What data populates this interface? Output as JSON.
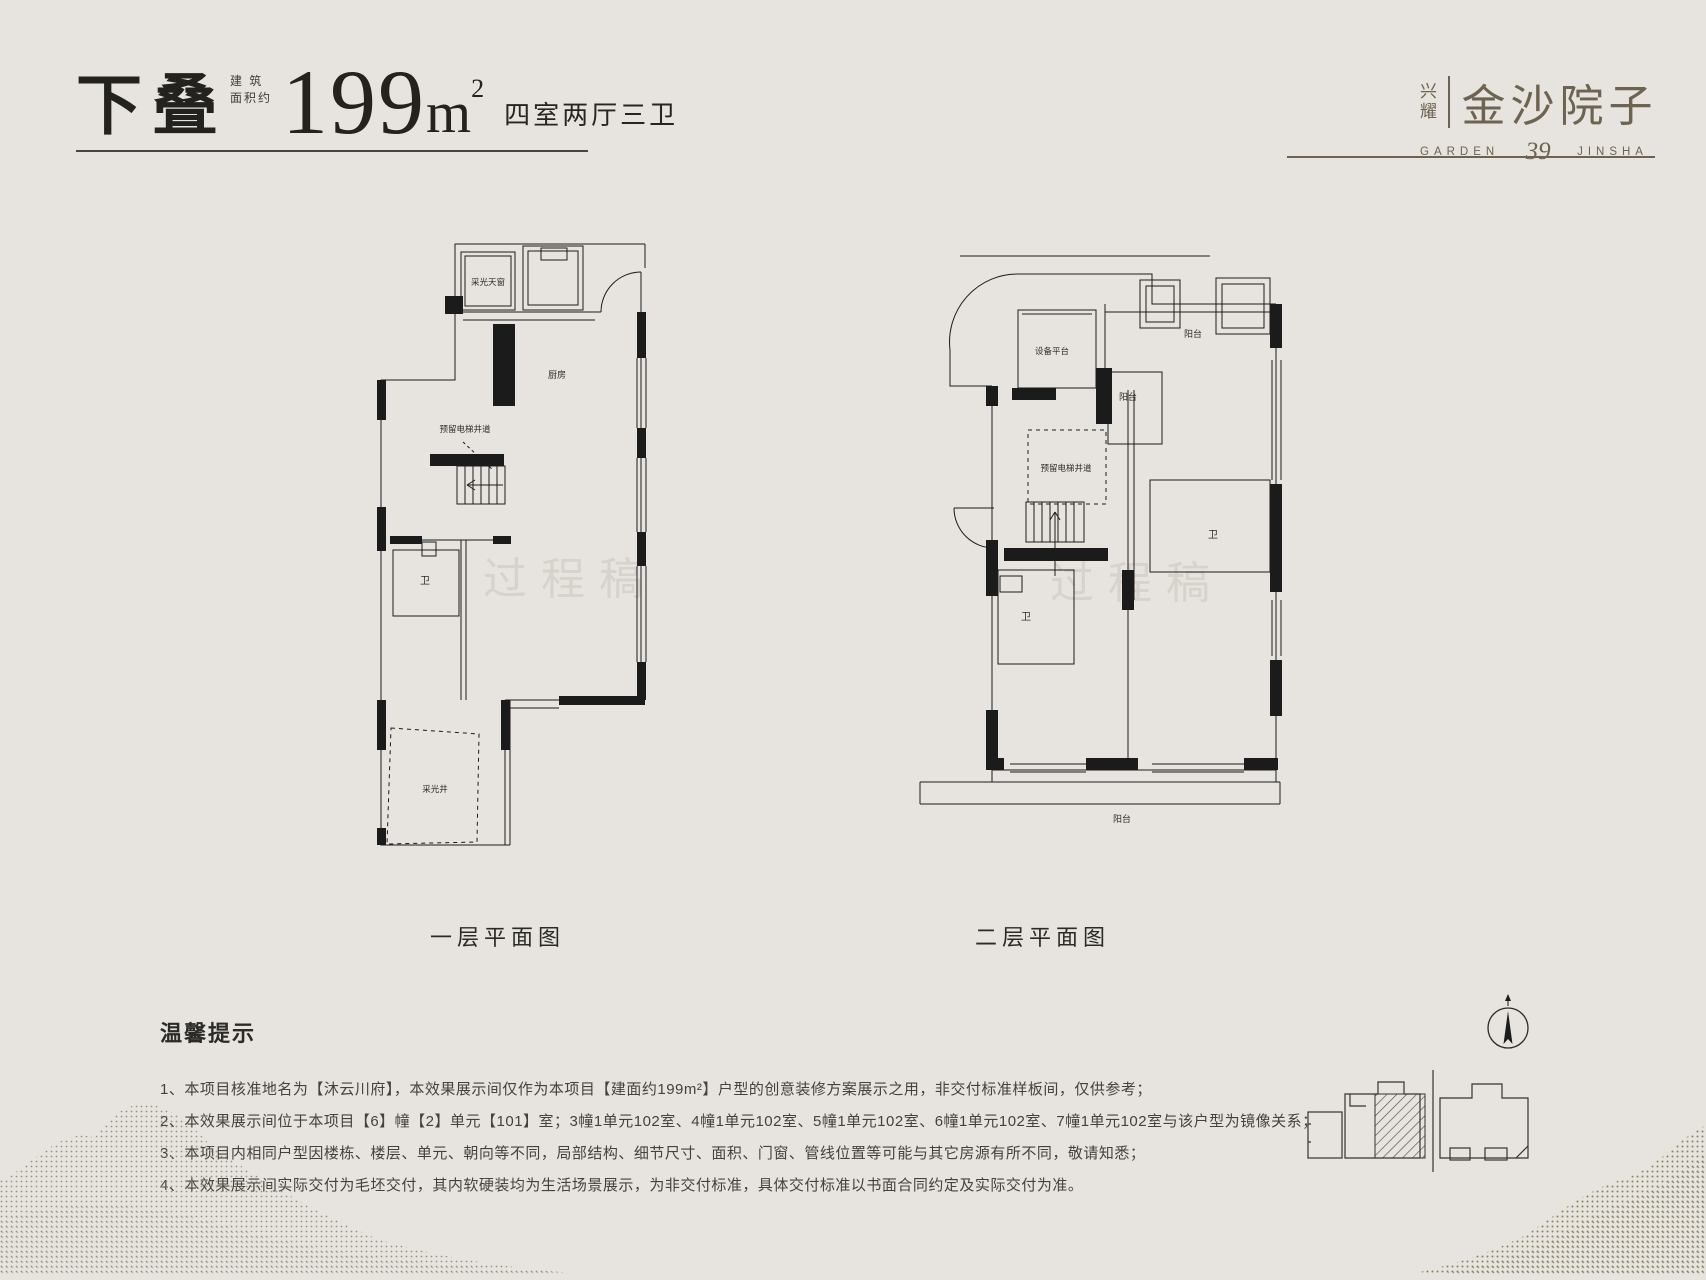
{
  "page": {
    "background": "#e7e4df"
  },
  "header": {
    "type_tag": "下叠",
    "area_prefix_line1": "建 筑",
    "area_prefix_line2": "面积约",
    "area_number": "199",
    "area_unit": "m",
    "area_power": "2",
    "layout_text": "四室两厅三卫"
  },
  "logo": {
    "brand_top": "兴",
    "brand_bottom": "耀",
    "name": "金沙院子",
    "sub_left": "GARDEN",
    "sub_number": "39",
    "sub_right": "JINSHA"
  },
  "plans": {
    "first": {
      "caption": "一层平面图",
      "watermark": "过程稿",
      "labels": {
        "skylight": "采光天窗",
        "kitchen": "厨房",
        "elevator_shaft": "预留电梯井道",
        "bath": "卫",
        "light_well": "采光井"
      }
    },
    "second": {
      "caption": "二层平面图",
      "watermark": "过程稿",
      "labels": {
        "equipment_platform": "设备平台",
        "balcony_top": "阳台",
        "balcony_mid": "阳台",
        "elevator_shaft": "预留电梯井道",
        "bath_left": "卫",
        "bath_right": "卫",
        "terrace": "阳台"
      }
    }
  },
  "notes": {
    "title": "温馨提示",
    "items": [
      "1、本项目核准地名为【沐云川府】，本效果展示间仅作为本项目【建面约199m²】户型的创意装修方案展示之用，非交付标准样板间，仅供参考；",
      "2、本效果展示间位于本项目【6】幢【2】单元【101】室；3幢1单元102室、4幢1单元102室、5幢1单元102室、6幢1单元102室、7幢1单元102室与该户型为镜像关系；",
      "3、本项目内相同户型因楼栋、楼层、单元、朝向等不同，局部结构、细节尺寸、面积、门窗、管线位置等可能与其它房源有所不同，敬请知悉；",
      "4、本效果展示间实际交付为毛坯交付，其内软硬装均为生活场景展示，为非交付标准，具体交付标准以书面合同约定及实际交付为准。"
    ]
  },
  "colors": {
    "ink": "#24221e",
    "brand": "#6c6450",
    "plan_line": "#1b1b1b",
    "watermark": "#d7d3cc",
    "note_text": "#44423d",
    "mountain_left": "#87816f",
    "mountain_right": "#7d774c"
  }
}
